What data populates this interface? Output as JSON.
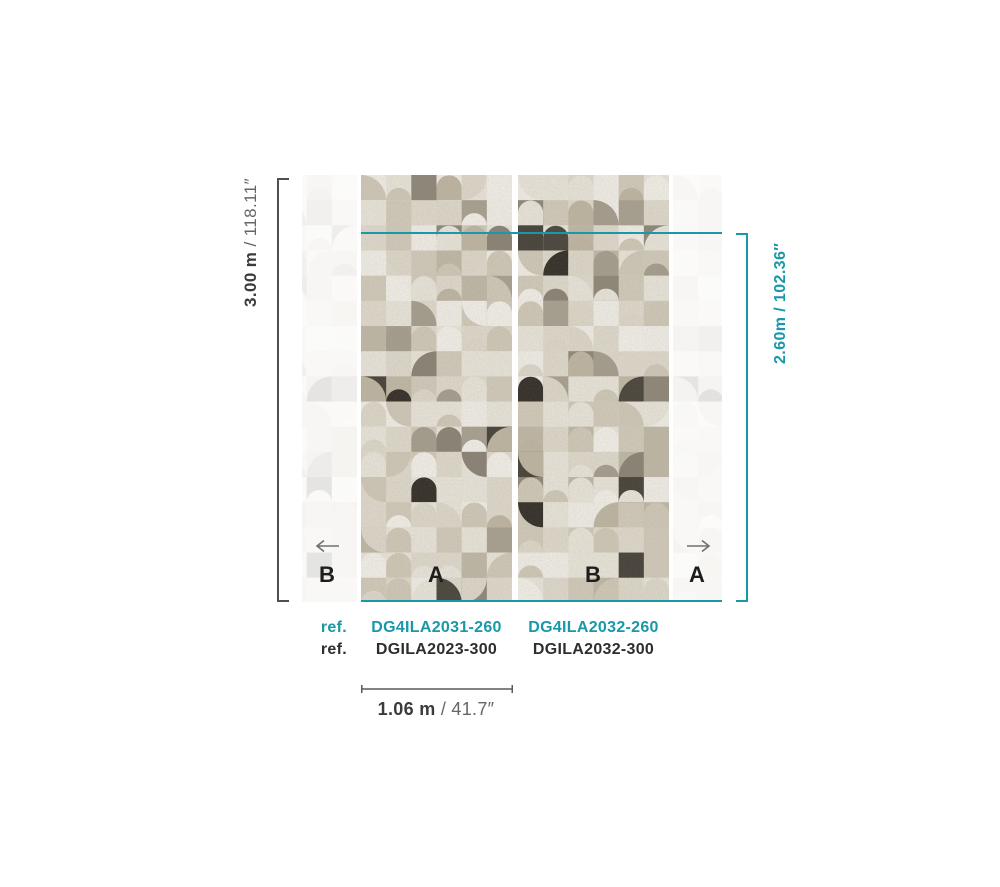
{
  "dimensions": {
    "height": {
      "metric": "3.00 m",
      "sep": " / ",
      "imperial": "118.11″"
    },
    "drop": {
      "metric": "2.60m",
      "sep": " / ",
      "imperial": "102.36″"
    },
    "width": {
      "metric": "1.06 m",
      "sep": " / ",
      "imperial": "41.7″"
    }
  },
  "panels": {
    "repeat_left": "B",
    "a": "A",
    "b": "B",
    "repeat_right": "A"
  },
  "refs": {
    "row_260": {
      "label": "ref.",
      "panel_a": "DG4ILA2031-260",
      "panel_b": "DG4ILA2032-260"
    },
    "row_300": {
      "label": "ref.",
      "panel_a": "DGILA2023-300",
      "panel_b": "DGILA2032-300"
    }
  },
  "icons": {
    "arrow_left": "arrow-left-icon",
    "arrow_right": "arrow-right-icon"
  },
  "colors": {
    "teal": "#1898a8",
    "bracket_gray": "#4f4f4f",
    "text_dark": "#3b3b3b",
    "text_gray": "#666666",
    "ref_black": "#2e2e2e",
    "letter_black": "#1d1d1b",
    "arrow_gray": "#707070"
  },
  "wallpaper": {
    "seeds": {
      "a": 101,
      "b": 202
    },
    "grid": {
      "cols": 6,
      "rows": 17,
      "tile": 25.17
    },
    "background_weights": [
      [
        "#f0ede6",
        5
      ],
      [
        "#e8e4d9",
        6
      ],
      [
        "#dfd9cc",
        5
      ],
      [
        "#d1caba",
        4
      ],
      [
        "#c0b8a6",
        2.5
      ],
      [
        "#a8a090",
        1.5
      ],
      [
        "#8f8778",
        0.8
      ],
      [
        "#46423a",
        0.45
      ],
      [
        "#332f28",
        0.35
      ]
    ],
    "shape_weights": [
      [
        "none",
        5
      ],
      [
        "arch",
        5
      ],
      [
        "dome",
        2.5
      ],
      [
        "quarter",
        4
      ]
    ],
    "foreground_weights": [
      [
        "#f2efe8",
        3
      ],
      [
        "#e8e4d9",
        4
      ],
      [
        "#ddd7c9",
        4
      ],
      [
        "#cfc8b7",
        4
      ],
      [
        "#beb5a2",
        3
      ],
      [
        "#a59d8d",
        2
      ],
      [
        "#8a8274",
        1.2
      ],
      [
        "#4a453c",
        0.8
      ],
      [
        "#332f28",
        0.6
      ]
    ]
  }
}
